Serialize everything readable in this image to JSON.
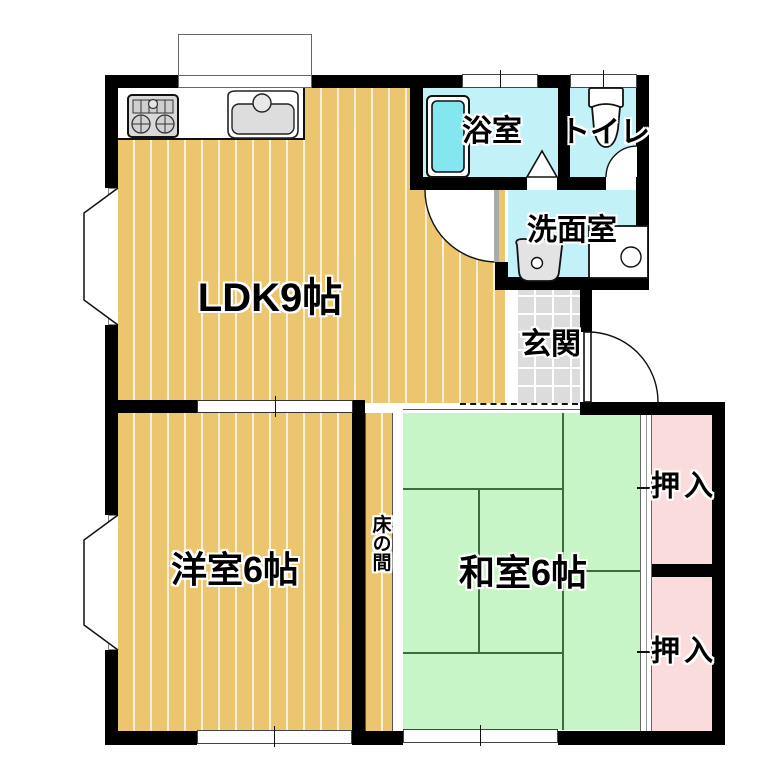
{
  "plan": {
    "title": "apartment-floor-plan",
    "labels": {
      "ldk": "LDK9帖",
      "bathroom": "浴室",
      "toilet": "トイレ",
      "washroom": "洗面室",
      "genkan": "玄関",
      "western_room": "洋室6帖",
      "japanese_room": "和室6帖",
      "tokonoma": "床の間",
      "closet_upper": "押入",
      "closet_lower": "押入"
    },
    "fixtures": [
      "gas-stove",
      "kitchen-sink",
      "bathtub",
      "bathroom-folding-door",
      "toilet-bowl",
      "toilet-door",
      "washbasin",
      "washing-machine-pan",
      "ldk-washroom-door",
      "entrance-door",
      "bay-window-ldk",
      "bay-window-western-room",
      "kitchen-window",
      "bathroom-window",
      "toilet-window",
      "western-room-window",
      "japanese-room-window",
      "sliding-door-ldk-western",
      "closet-sliding-doors",
      "genkan-step-dashed-line"
    ],
    "colors": {
      "wall": "#000000",
      "wood": "#ebc66e",
      "tatami": "#c7f5c7",
      "tatami_line": "#3c6e3c",
      "water": "#c2f1f7",
      "tub": "#84e7ef",
      "closet": "#fbdcdd",
      "tile": "#dcdcdc"
    }
  }
}
